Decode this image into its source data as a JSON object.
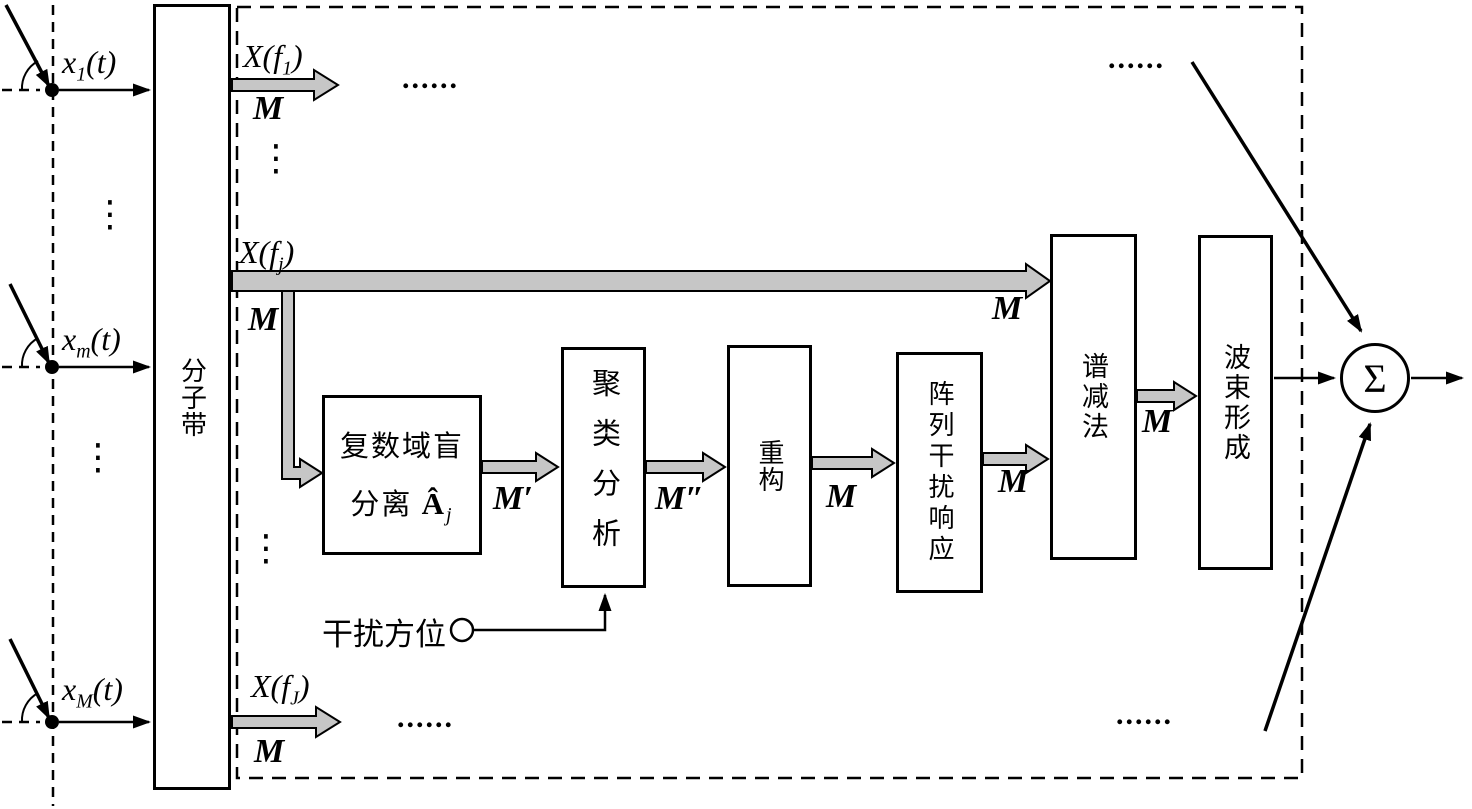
{
  "colors": {
    "background": "#ffffff",
    "line": "#000000",
    "arrow_fill": "#c6c6c6"
  },
  "antenna": {
    "inputs": [
      {
        "var": "x",
        "sub": "1",
        "arg": "(t)"
      },
      {
        "var": "x",
        "sub": "m",
        "arg": "(t)"
      },
      {
        "var": "x",
        "sub": "M",
        "arg": "(t)"
      }
    ]
  },
  "subband": {
    "label": "分子带"
  },
  "outputs": [
    {
      "fn": "X(f",
      "sub": "1",
      "close": ")",
      "count": "M"
    },
    {
      "fn": "X(f",
      "sub": "j",
      "close": ")",
      "count": "M"
    },
    {
      "fn": "X(f",
      "sub": "J",
      "close": ")",
      "count": "M"
    }
  ],
  "branch_count": "M",
  "long_arrow_count": "M",
  "chain": {
    "blind_separation": {
      "line1": "复数域盲",
      "line2_prefix": "分离 ",
      "matrix": "Â",
      "matrix_sub": "j",
      "out_count": "M′"
    },
    "clustering": {
      "label": "聚类分析",
      "out_count": "M″"
    },
    "reconstruction": {
      "label": "重构",
      "out_count": "M"
    },
    "array_interference_response": {
      "label": "阵列干扰响应",
      "out_count": "M"
    },
    "spectral_subtraction": {
      "label": "谱减法",
      "out_count": "M"
    },
    "beamforming": {
      "label": "波束形成"
    }
  },
  "interference": {
    "label": "干扰方位"
  },
  "summer": {
    "symbol": "Σ"
  },
  "ellipsis": {
    "horizontal": "......",
    "vertical": "⋮"
  }
}
